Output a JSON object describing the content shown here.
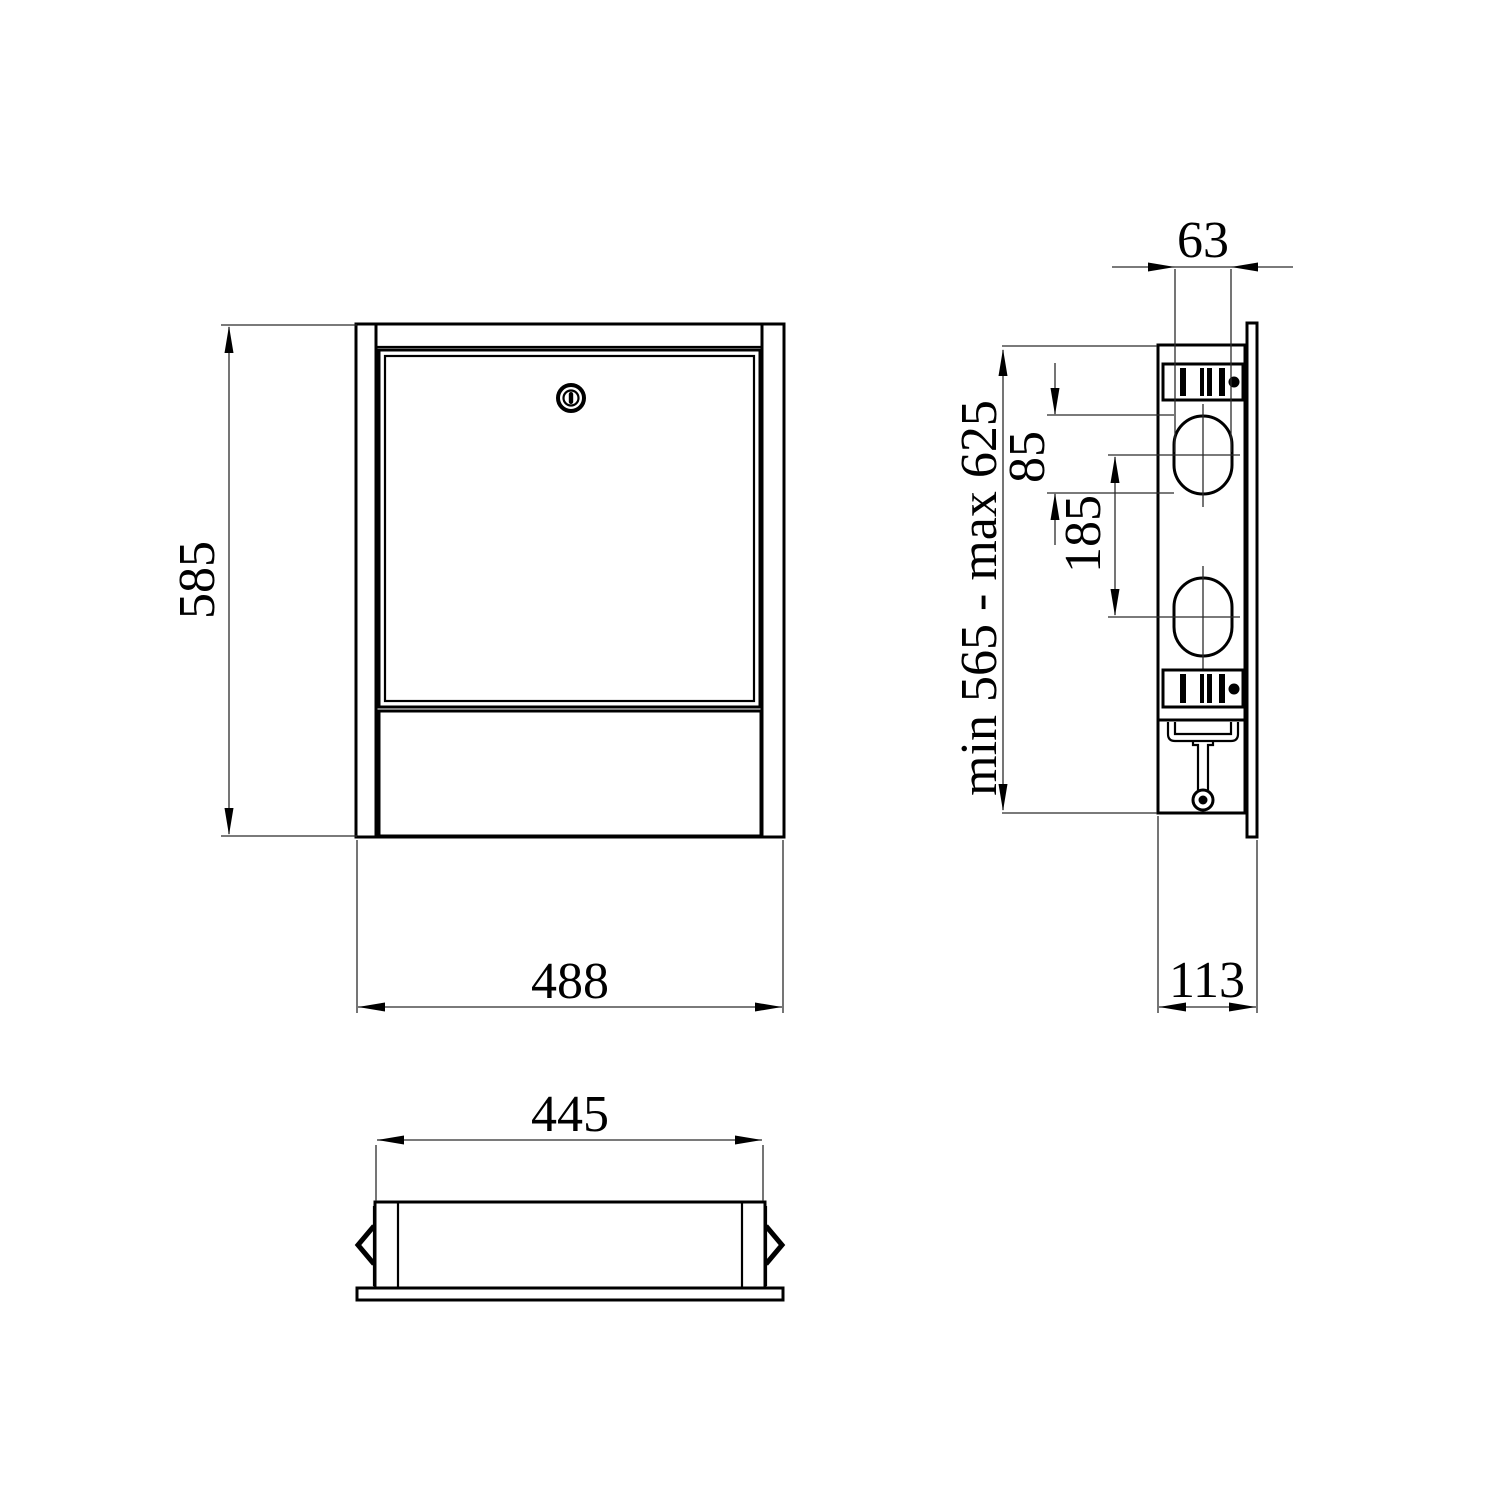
{
  "drawing": {
    "kind": "technical-drawing-three-views",
    "style": {
      "background": "#ffffff",
      "line_color": "#000000",
      "thin_line_color": "#2b2b2b"
    },
    "views": {
      "front": {
        "dims": {
          "height": {
            "label": "585"
          },
          "width": {
            "label": "488"
          }
        }
      },
      "side": {
        "dims": {
          "hole_width": {
            "label": "63"
          },
          "hole_height": {
            "label": "85"
          },
          "hole_spacing": {
            "label": "185"
          },
          "height_range": {
            "label": "min 565 - max 625"
          },
          "depth": {
            "label": "113"
          }
        }
      },
      "top": {
        "dims": {
          "width": {
            "label": "445"
          }
        }
      }
    }
  }
}
